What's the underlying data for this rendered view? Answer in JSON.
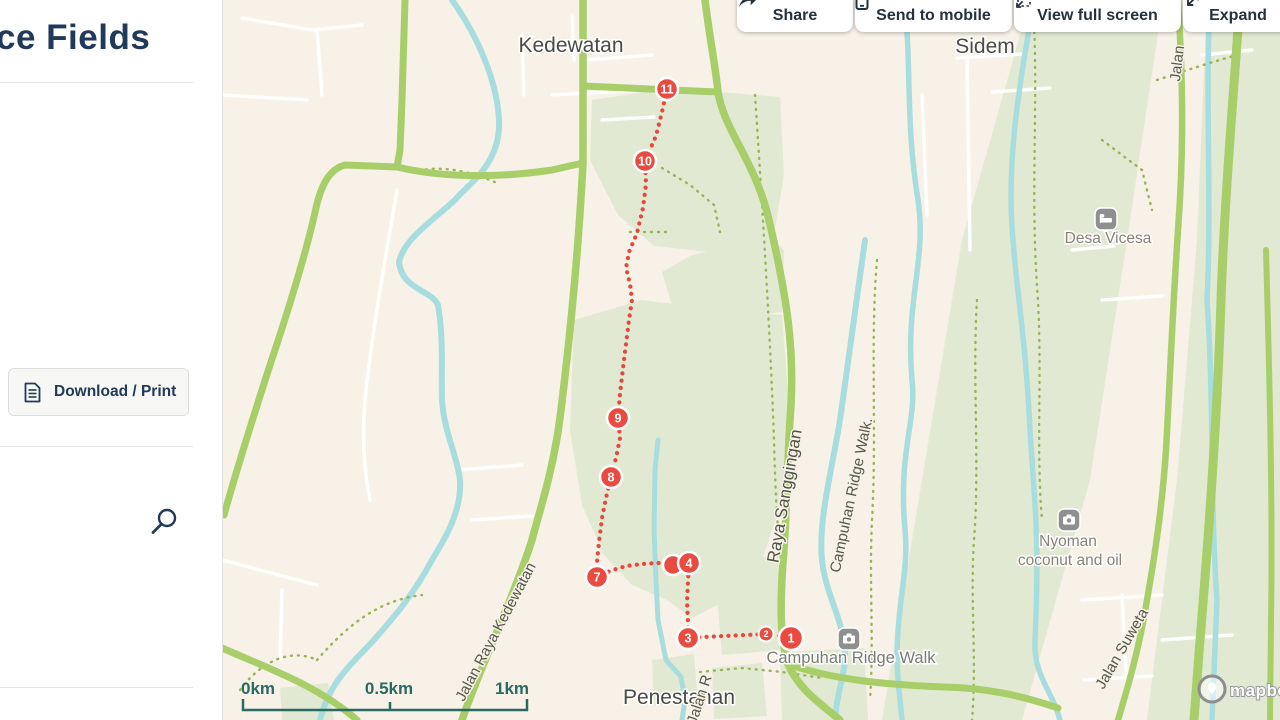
{
  "sidebar": {
    "title": "ce Fields",
    "download_print_label": "Download / Print"
  },
  "toolbar": {
    "share": "Share",
    "send_to_mobile": "Send to mobile",
    "view_full_screen": "View full screen",
    "expand": "Expand"
  },
  "map": {
    "places": {
      "kedewatan": "Kedewatan",
      "sidem": "Sidem",
      "penestanan": "Penestanan"
    },
    "pois": {
      "desa_vicesa": "Desa Vicesa",
      "nyoman_line1": "Nyoman",
      "nyoman_line2": "coconut and oil",
      "campuhan": "Campuhan Ridge Walk"
    },
    "roads": {
      "raya_sanggingan": "Raya Sanggingan",
      "campuhan_trail": "Campuhan Ridge Walk.",
      "jalan_raya_kedewatan": "Jalan Raya Kedewatan",
      "jalan_suweta": "Jalan Suweta",
      "jalan": "Jalan",
      "jalan_r": "Jalan R"
    },
    "scale": {
      "zero": "0km",
      "half": "0.5km",
      "one": "1km"
    },
    "attribution": "mapbox",
    "waypoints": [
      {
        "label": "11",
        "x": 445,
        "y": 89,
        "r": 11
      },
      {
        "label": "10",
        "x": 423,
        "y": 161,
        "r": 11
      },
      {
        "label": "9",
        "x": 396,
        "y": 418,
        "r": 11
      },
      {
        "label": "8",
        "x": 389,
        "y": 477,
        "r": 11
      },
      {
        "label": "7",
        "x": 375,
        "y": 577,
        "r": 11
      },
      {
        "label": "",
        "x": 451,
        "y": 565,
        "r": 10
      },
      {
        "label": "4",
        "x": 467,
        "y": 563,
        "r": 11
      },
      {
        "label": "3",
        "x": 466,
        "y": 638,
        "r": 11
      },
      {
        "label": "2",
        "x": 544,
        "y": 634,
        "r": 7.5
      },
      {
        "label": "1",
        "x": 569,
        "y": 638,
        "r": 12
      }
    ],
    "colors": {
      "route_red": "#e8473c",
      "marker_red": "#ea4b40",
      "road_green": "#a8ce69",
      "river_teal": "#a8dde0",
      "land_beige": "#f7f1e7",
      "area_green": "#e1e9d3",
      "scale_teal": "#2b6a63",
      "navy": "#21395a"
    }
  }
}
